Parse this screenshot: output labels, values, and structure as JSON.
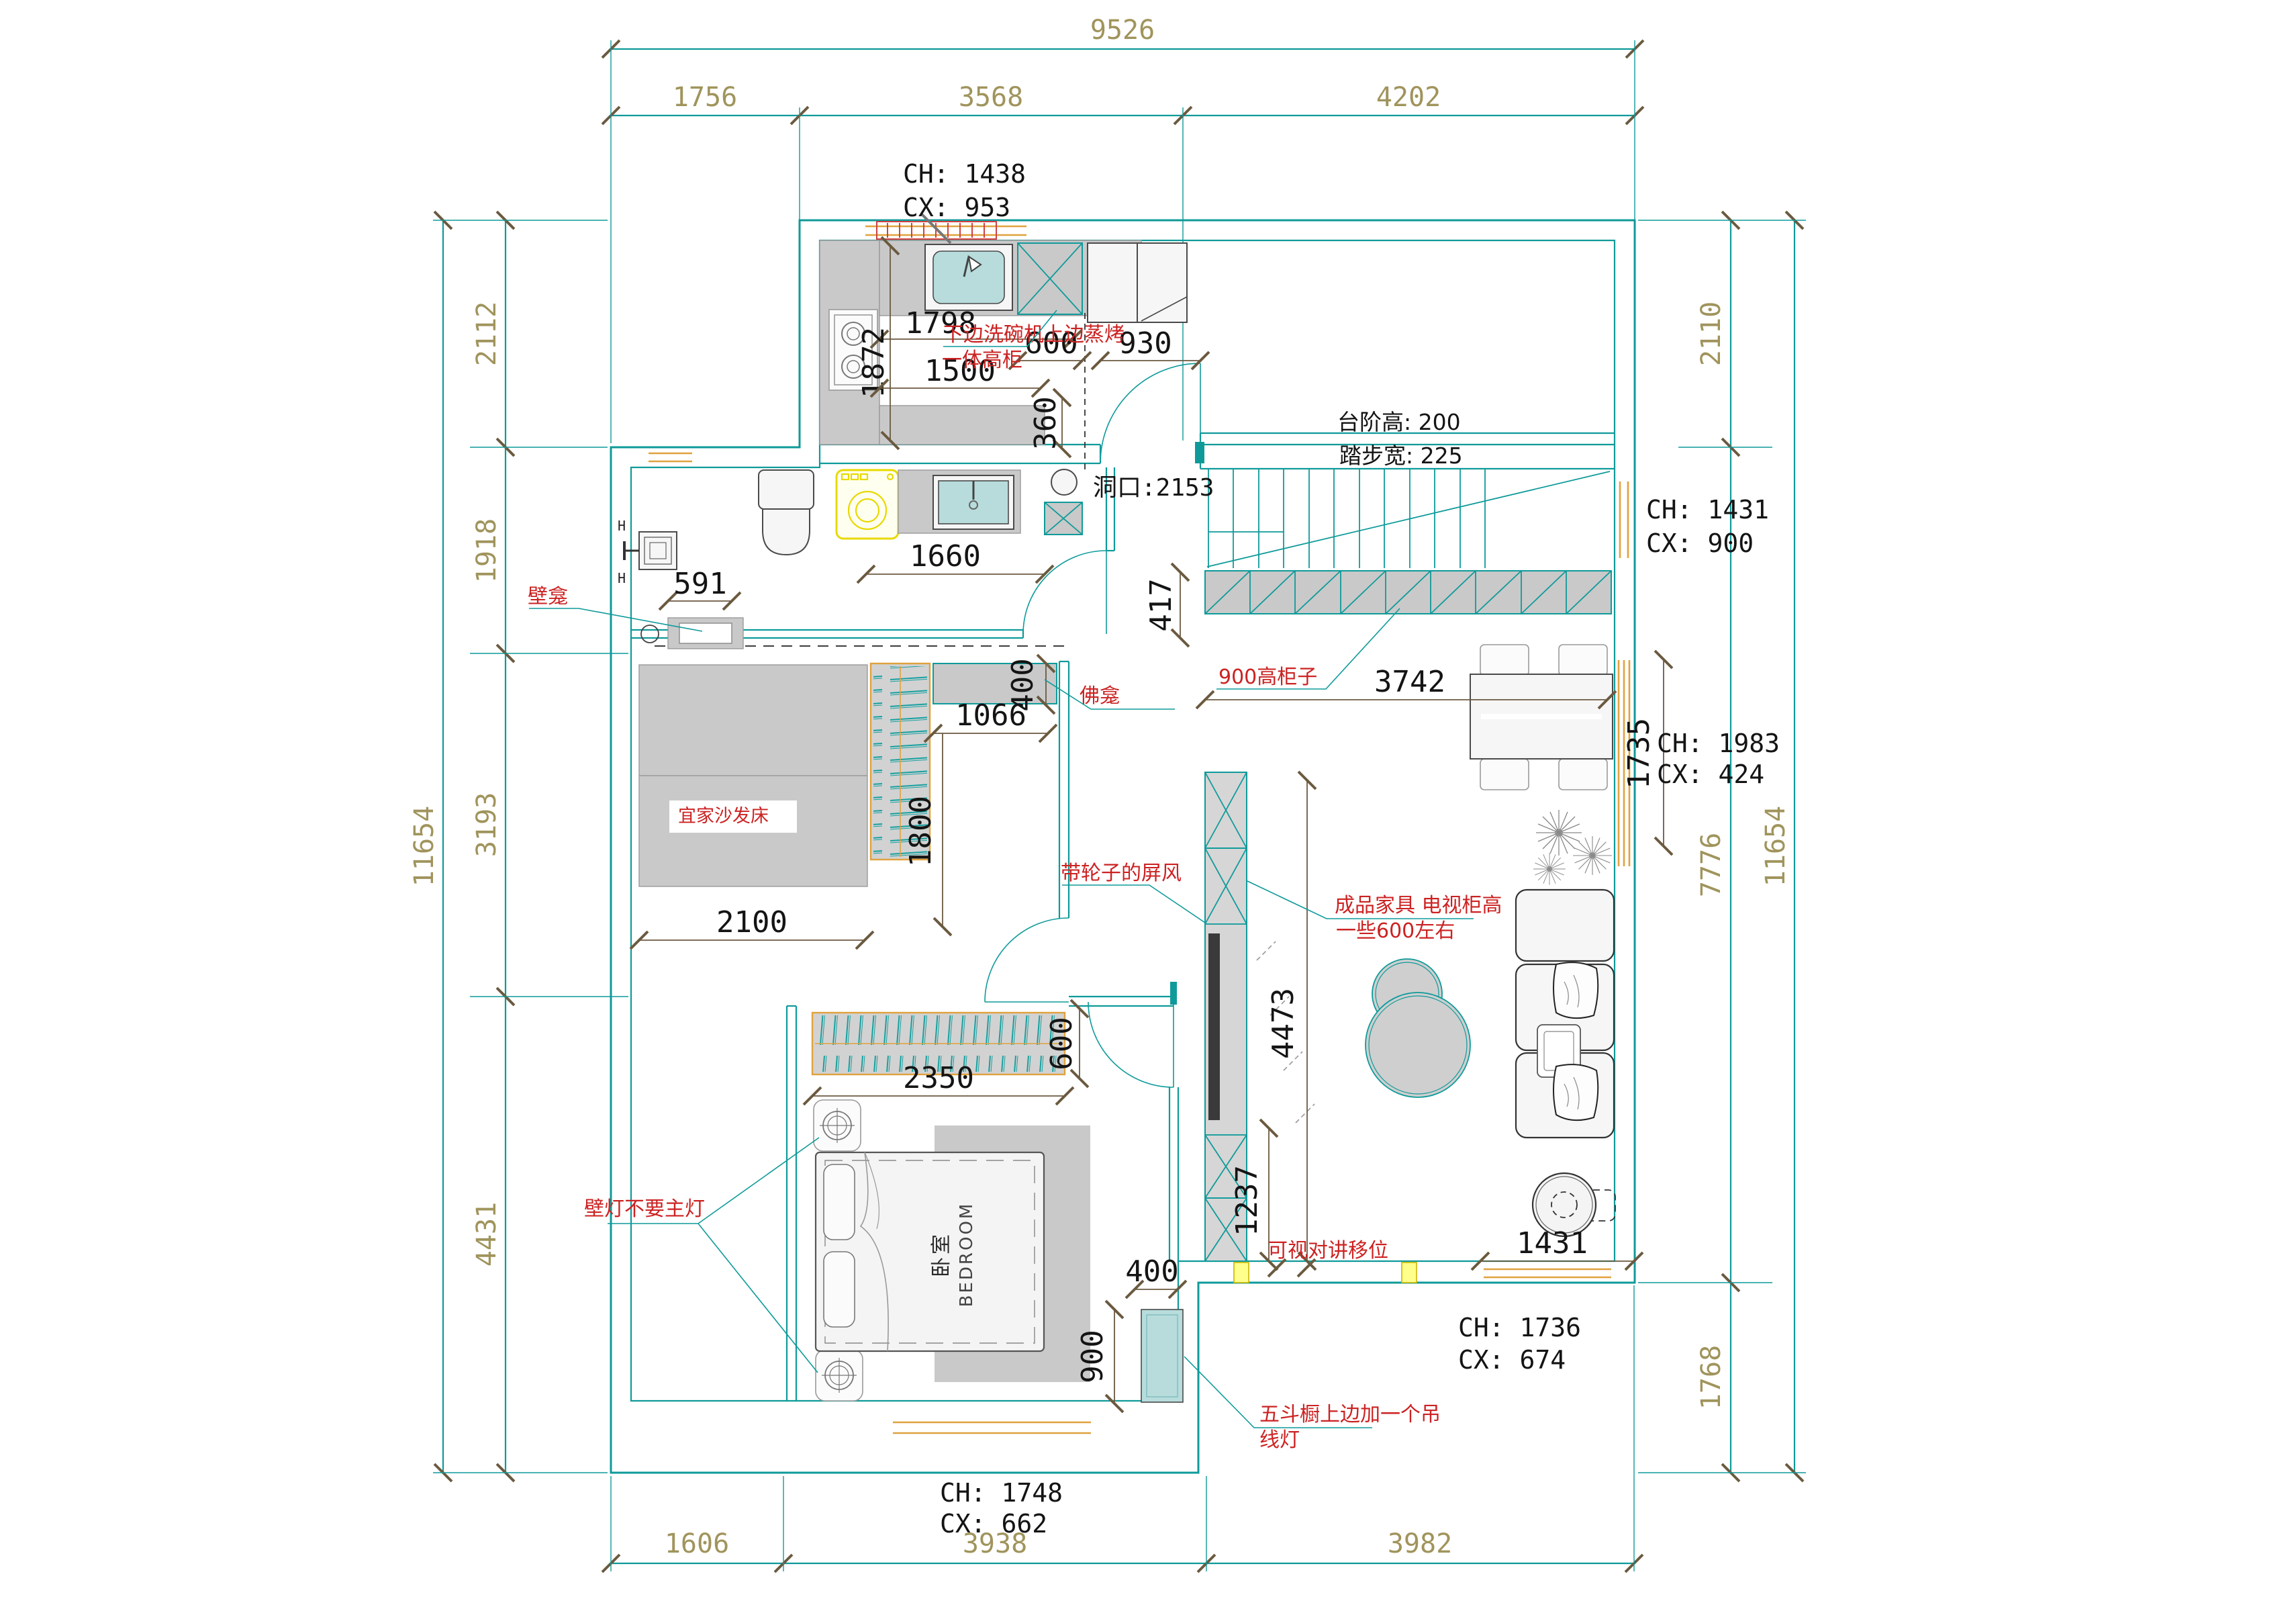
{
  "colors": {
    "wall": "#0f9a9a",
    "dim_chain_text": "#a0945c",
    "interior_dim_text": "#141414",
    "annotation": "#cc2222",
    "window": "#e0a23e",
    "tick": "#6b5a40",
    "furniture_fill": "#c9c9c9",
    "basin_fill": "#b8dcdc",
    "highlight": "#e8d900"
  },
  "dims": {
    "top": {
      "total": "9526",
      "segs": [
        "1756",
        "3568",
        "4202"
      ]
    },
    "bottom": {
      "segs": [
        "1606",
        "3938",
        "3982"
      ]
    },
    "left": {
      "total": "11654",
      "segs": [
        "2112",
        "1918",
        "3193",
        "4431"
      ]
    },
    "right": {
      "total": "11654",
      "segs": [
        "2110",
        "7776",
        "1768"
      ]
    },
    "interior": {
      "counter_len": "1798",
      "counter_depth": "1872",
      "dishwasher": "600",
      "entry_door": "930",
      "lower_counter": "1500",
      "lower_depth": "360",
      "opening": "洞口:2153",
      "stair_cab_len": "3742",
      "stair_cab_gap": "417",
      "bath_counter": "1660",
      "bath_niche": "591",
      "buddha_depth": "400",
      "buddha_len": "1066",
      "screen_len": "1800",
      "sofa_len": "2100",
      "closet_len": "2350",
      "closet_depth": "600",
      "hall_len": "4473",
      "hall_part": "1237",
      "dresser_w": "400",
      "dresser_len": "900",
      "living_window": "1431",
      "dining_window": "1735"
    }
  },
  "labels": {
    "ch_top": "CH: 1438",
    "cx_top": "CX: 953",
    "ch_stair": "CH: 1431",
    "cx_stair": "CX: 900",
    "ch_dining": "CH: 1983",
    "cx_dining": "CX: 424",
    "ch_living": "CH: 1736",
    "cx_living": "CX: 674",
    "ch_bedroom": "CH: 1748",
    "cx_bedroom": "CX: 662",
    "stair_rise": "台阶高: 200",
    "stair_tread": "踏步宽: 225",
    "room_cn": "卧室",
    "room_en": "BEDROOM"
  },
  "annotations": {
    "kitchen_1": "下边洗碗机上边蒸烤",
    "kitchen_2": "一体高柜",
    "wall_niche": "壁龛",
    "buddha_niche": "佛龛",
    "stair_cabinet": "900高柜子",
    "sofa_bed": "宜家沙发床",
    "screen": "带轮子的屏风",
    "tv_1": "成品家具 电视柜高",
    "tv_2": "一些600左右",
    "wall_lamp": "壁灯不要主灯",
    "intercom": "可视对讲移位",
    "dresser_1": "五斗橱上边加一个吊",
    "dresser_2": "线灯"
  }
}
